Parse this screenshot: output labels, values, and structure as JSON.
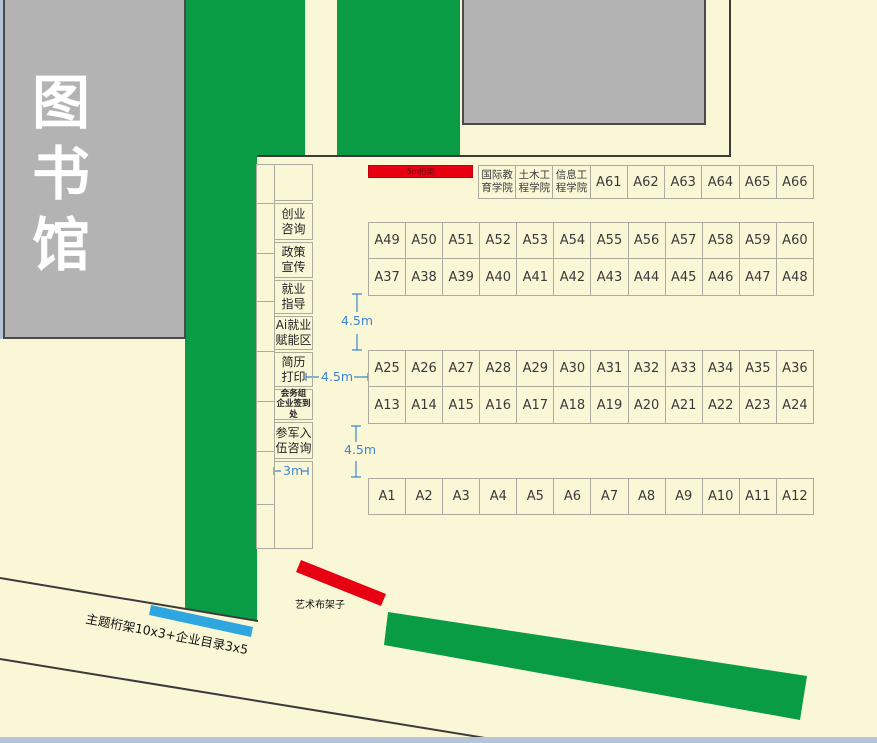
{
  "buildings": {
    "library": "图书馆"
  },
  "top_truss": {
    "label": "5m桁架"
  },
  "booths": {
    "header_row": [
      {
        "label": "国际教\n育学院",
        "cls": "college"
      },
      {
        "label": "土木工\n程学院",
        "cls": "college"
      },
      {
        "label": "信息工\n程学院",
        "cls": "college"
      },
      "A61",
      "A62",
      "A63",
      "A64",
      "A65",
      "A66"
    ],
    "row_a49": [
      "A49",
      "A50",
      "A51",
      "A52",
      "A53",
      "A54",
      "A55",
      "A56",
      "A57",
      "A58",
      "A59",
      "A60"
    ],
    "row_a37": [
      "A37",
      "A38",
      "A39",
      "A40",
      "A41",
      "A42",
      "A43",
      "A44",
      "A45",
      "A46",
      "A47",
      "A48"
    ],
    "row_a25": [
      "A25",
      "A26",
      "A27",
      "A28",
      "A29",
      "A30",
      "A31",
      "A32",
      "A33",
      "A34",
      "A35",
      "A36"
    ],
    "row_a13": [
      "A13",
      "A14",
      "A15",
      "A16",
      "A17",
      "A18",
      "A19",
      "A20",
      "A21",
      "A22",
      "A23",
      "A24"
    ],
    "row_a1": [
      "A1",
      "A2",
      "A3",
      "A4",
      "A5",
      "A6",
      "A7",
      "A8",
      "A9",
      "A10",
      "A11",
      "A12"
    ]
  },
  "services": {
    "items": [
      {
        "label": ""
      },
      {
        "label": "创业\n咨询"
      },
      {
        "label": "政策\n宣传"
      },
      {
        "label": "就业\n指导"
      },
      {
        "label": "Ai就业\n赋能区"
      },
      {
        "label": "简历\n打印"
      },
      {
        "label": "会务组\n企业签到处"
      },
      {
        "label": "参军入\n伍咨询"
      },
      {
        "label": ""
      }
    ]
  },
  "dimensions": {
    "gap_rows_top": "4.5m",
    "gap_rows_bottom": "4.5m",
    "gap_left": "4.5m",
    "path_width": "3m"
  },
  "annotations": {
    "art_rack": "艺术布架子",
    "theme_truss": "主题桁架10x3+企业目录3x5"
  },
  "colors": {
    "background": "#FAF7D7",
    "green_area": "#099C45",
    "building_gray": "#B3B3B3",
    "truss_red": "#E60012",
    "directory_blue": "#2EA7E0",
    "dimension_blue": "#3E86CE",
    "canvas_edge": "#B5C4D6"
  }
}
